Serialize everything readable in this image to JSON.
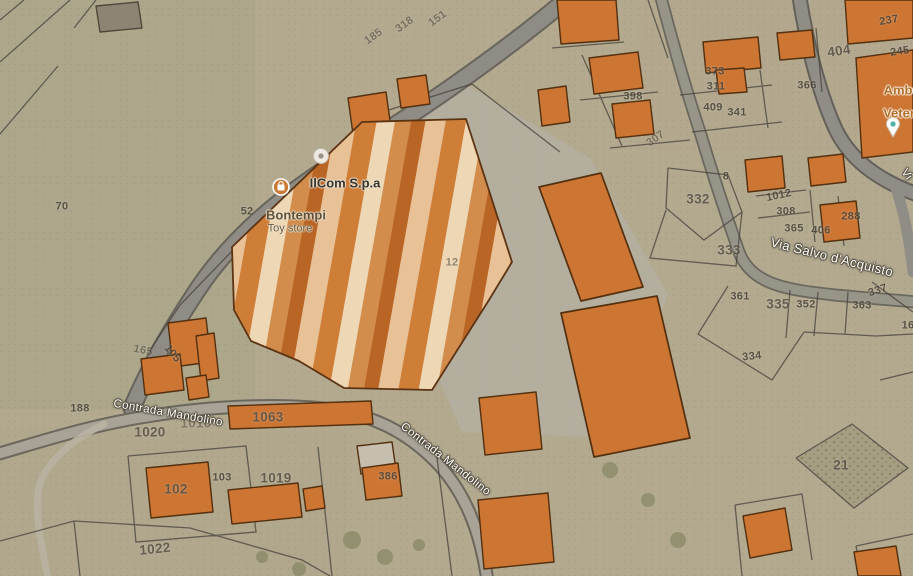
{
  "map": {
    "poi_labels": [
      {
        "id": "ilcom",
        "text": "IlCom S.p.a",
        "x": 345,
        "y": 183,
        "rot": 0,
        "cls": "poi-dark",
        "interactable": true
      },
      {
        "id": "bontempi",
        "text": "Bontempi",
        "x": 296,
        "y": 215,
        "rot": 0,
        "cls": "poi-shop",
        "interactable": true
      },
      {
        "id": "toy-store",
        "text": "Toy store",
        "x": 290,
        "y": 229,
        "rot": 0,
        "cls": "poi-shop-sm",
        "interactable": true
      },
      {
        "id": "ambulatorio",
        "text": "Ambu",
        "x": 902,
        "y": 90,
        "rot": 0,
        "cls": "poi-amber",
        "interactable": true
      },
      {
        "id": "veterinario",
        "text": "Veter",
        "x": 899,
        "y": 113,
        "rot": 0,
        "cls": "poi-amber",
        "interactable": true
      }
    ],
    "street_labels": [
      {
        "id": "contrada-mandolino-west",
        "text": "Contrada Mandolino",
        "x": 168,
        "y": 414,
        "rot": 10,
        "cls": "street",
        "interactable": false
      },
      {
        "id": "contrada-mandolino-south",
        "text": "Contrada Mandolino",
        "x": 445,
        "y": 460,
        "rot": 38,
        "cls": "street",
        "interactable": false
      },
      {
        "id": "via-salvo-dacquisto",
        "text": "Via Salvo d'Acquisto",
        "x": 832,
        "y": 257,
        "rot": 14,
        "cls": "street street-lg",
        "interactable": false
      },
      {
        "id": "via-clipped",
        "text": "Vi",
        "x": 906,
        "y": 175,
        "rot": 55,
        "cls": "street",
        "interactable": false
      }
    ],
    "parcel_numbers": [
      {
        "id": "p70",
        "text": "70",
        "x": 62,
        "y": 207,
        "rot": 0,
        "cls": "num"
      },
      {
        "id": "p52",
        "text": "52",
        "x": 247,
        "y": 212,
        "rot": 0,
        "cls": "num"
      },
      {
        "id": "p185",
        "text": "185",
        "x": 374,
        "y": 37,
        "rot": -36,
        "cls": "num faint"
      },
      {
        "id": "p318",
        "text": "318",
        "x": 405,
        "y": 25,
        "rot": -36,
        "cls": "num faint"
      },
      {
        "id": "p151",
        "text": "151",
        "x": 438,
        "y": 19,
        "rot": -36,
        "cls": "num faint"
      },
      {
        "id": "p105",
        "text": "105",
        "x": 172,
        "y": 354,
        "rot": 50,
        "cls": "num"
      },
      {
        "id": "p165",
        "text": "165",
        "x": 143,
        "y": 351,
        "rot": 12,
        "cls": "num faint"
      },
      {
        "id": "p188",
        "text": "188",
        "x": 80,
        "y": 409,
        "rot": 0,
        "cls": "num"
      },
      {
        "id": "p1020",
        "text": "1020",
        "x": 150,
        "y": 432,
        "rot": 0,
        "cls": "num lg"
      },
      {
        "id": "p1010",
        "text": "1010",
        "x": 196,
        "y": 423,
        "rot": 0,
        "cls": "num lg faint"
      },
      {
        "id": "p1063",
        "text": "1063",
        "x": 268,
        "y": 417,
        "rot": 0,
        "cls": "num lg"
      },
      {
        "id": "p102",
        "text": "102",
        "x": 176,
        "y": 489,
        "rot": 0,
        "cls": "num lg"
      },
      {
        "id": "p103",
        "text": "103",
        "x": 222,
        "y": 478,
        "rot": 0,
        "cls": "num"
      },
      {
        "id": "p1019",
        "text": "1019",
        "x": 276,
        "y": 478,
        "rot": 0,
        "cls": "num lg"
      },
      {
        "id": "p1022",
        "text": "1022",
        "x": 155,
        "y": 549,
        "rot": -6,
        "cls": "num lg"
      },
      {
        "id": "p386",
        "text": "386",
        "x": 388,
        "y": 477,
        "rot": 0,
        "cls": "num"
      },
      {
        "id": "p12",
        "text": "12",
        "x": 452,
        "y": 263,
        "rot": 0,
        "cls": "num faint"
      },
      {
        "id": "p398",
        "text": "398",
        "x": 633,
        "y": 97,
        "rot": 0,
        "cls": "num"
      },
      {
        "id": "p307",
        "text": "307",
        "x": 656,
        "y": 139,
        "rot": -35,
        "cls": "num faint"
      },
      {
        "id": "p8",
        "text": "8",
        "x": 726,
        "y": 177,
        "rot": 0,
        "cls": "num"
      },
      {
        "id": "p373",
        "text": "373",
        "x": 715,
        "y": 72,
        "rot": 0,
        "cls": "num"
      },
      {
        "id": "p311",
        "text": "311",
        "x": 716,
        "y": 87,
        "rot": 0,
        "cls": "num"
      },
      {
        "id": "p409",
        "text": "409",
        "x": 713,
        "y": 108,
        "rot": 0,
        "cls": "num"
      },
      {
        "id": "p341",
        "text": "341",
        "x": 737,
        "y": 113,
        "rot": 0,
        "cls": "num"
      },
      {
        "id": "p366",
        "text": "366",
        "x": 807,
        "y": 86,
        "rot": 0,
        "cls": "num"
      },
      {
        "id": "p404",
        "text": "404",
        "x": 839,
        "y": 51,
        "rot": -8,
        "cls": "num lg"
      },
      {
        "id": "p237",
        "text": "237",
        "x": 889,
        "y": 21,
        "rot": -10,
        "cls": "num"
      },
      {
        "id": "p245",
        "text": "245",
        "x": 900,
        "y": 52,
        "rot": -8,
        "cls": "num"
      },
      {
        "id": "p1012",
        "text": "1012",
        "x": 779,
        "y": 196,
        "rot": -12,
        "cls": "num"
      },
      {
        "id": "p308",
        "text": "308",
        "x": 786,
        "y": 212,
        "rot": 0,
        "cls": "num"
      },
      {
        "id": "p365",
        "text": "365",
        "x": 794,
        "y": 229,
        "rot": 0,
        "cls": "num"
      },
      {
        "id": "p406",
        "text": "406",
        "x": 821,
        "y": 231,
        "rot": 0,
        "cls": "num"
      },
      {
        "id": "p288",
        "text": "288",
        "x": 851,
        "y": 217,
        "rot": 0,
        "cls": "num"
      },
      {
        "id": "p332",
        "text": "332",
        "x": 698,
        "y": 199,
        "rot": 0,
        "cls": "num lg"
      },
      {
        "id": "p333",
        "text": "333",
        "x": 729,
        "y": 250,
        "rot": 0,
        "cls": "num lg"
      },
      {
        "id": "p361",
        "text": "361",
        "x": 740,
        "y": 297,
        "rot": 0,
        "cls": "num"
      },
      {
        "id": "p335",
        "text": "335",
        "x": 778,
        "y": 304,
        "rot": 0,
        "cls": "num lg"
      },
      {
        "id": "p352",
        "text": "352",
        "x": 806,
        "y": 305,
        "rot": 0,
        "cls": "num"
      },
      {
        "id": "p363",
        "text": "363",
        "x": 862,
        "y": 306,
        "rot": 0,
        "cls": "num"
      },
      {
        "id": "p337",
        "text": "337",
        "x": 878,
        "y": 291,
        "rot": -18,
        "cls": "num"
      },
      {
        "id": "p334",
        "text": "334",
        "x": 752,
        "y": 357,
        "rot": -6,
        "cls": "num"
      },
      {
        "id": "p16",
        "text": "16",
        "x": 908,
        "y": 326,
        "rot": 0,
        "cls": "num"
      },
      {
        "id": "p21",
        "text": "21",
        "x": 841,
        "y": 465,
        "rot": 0,
        "cls": "num lg"
      }
    ],
    "pois": [
      {
        "id": "shopping-pin",
        "kind": "shopping-bag"
      },
      {
        "id": "generic-pin",
        "kind": "generic-place"
      },
      {
        "id": "veterinary-pin",
        "kind": "place-teal"
      }
    ],
    "colors": {
      "terrain": "#b2a98f",
      "road_fill": "#8e8c85",
      "building_fill": "#cd7533",
      "building_outline": "#53300f",
      "factory_stripe_light": "#ecd2ae",
      "factory_stripe_dark": "#cd7c36",
      "street_label_text": "#fffdf5",
      "parcel_number_text": "#48433a",
      "poi_amber_text": "#b06f2a"
    }
  }
}
